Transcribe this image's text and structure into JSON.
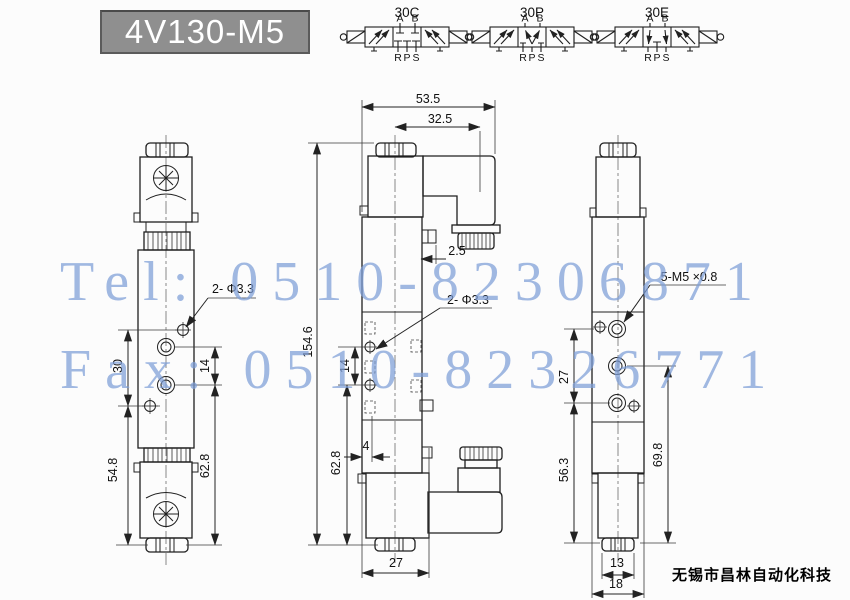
{
  "title": "4V130-M5",
  "watermark": {
    "line1": "Tel: 0510-82306871",
    "line2": "Fax: 0510-82326771"
  },
  "footer": {
    "company": "无锡市昌林自动化科技"
  },
  "schematics": {
    "items": [
      {
        "label": "30C"
      },
      {
        "label": "30P"
      },
      {
        "label": "30E"
      }
    ],
    "ports": {
      "a": "A",
      "b": "B",
      "r": "R",
      "p": "P",
      "s": "S"
    }
  },
  "dims": {
    "front": {
      "hole": "2- Φ3.3",
      "s30": "30",
      "s14": "14",
      "s548": "54.8",
      "s628": "62.8"
    },
    "side": {
      "w535": "53.5",
      "w325": "32.5",
      "t25": "2.5",
      "h1546": "154.6",
      "s14": "14",
      "s628": "62.8",
      "o4": "4",
      "w27": "27",
      "hole": "2- Φ3.3"
    },
    "back": {
      "thread": "5-M5 ×0.8",
      "s27": "27",
      "s563": "56.3",
      "s698": "69.8",
      "w13": "13",
      "w18": "18"
    }
  },
  "colors": {
    "watermark": "#7d9ed8",
    "title_bg": "#8f8f8f",
    "line": "#222222"
  }
}
